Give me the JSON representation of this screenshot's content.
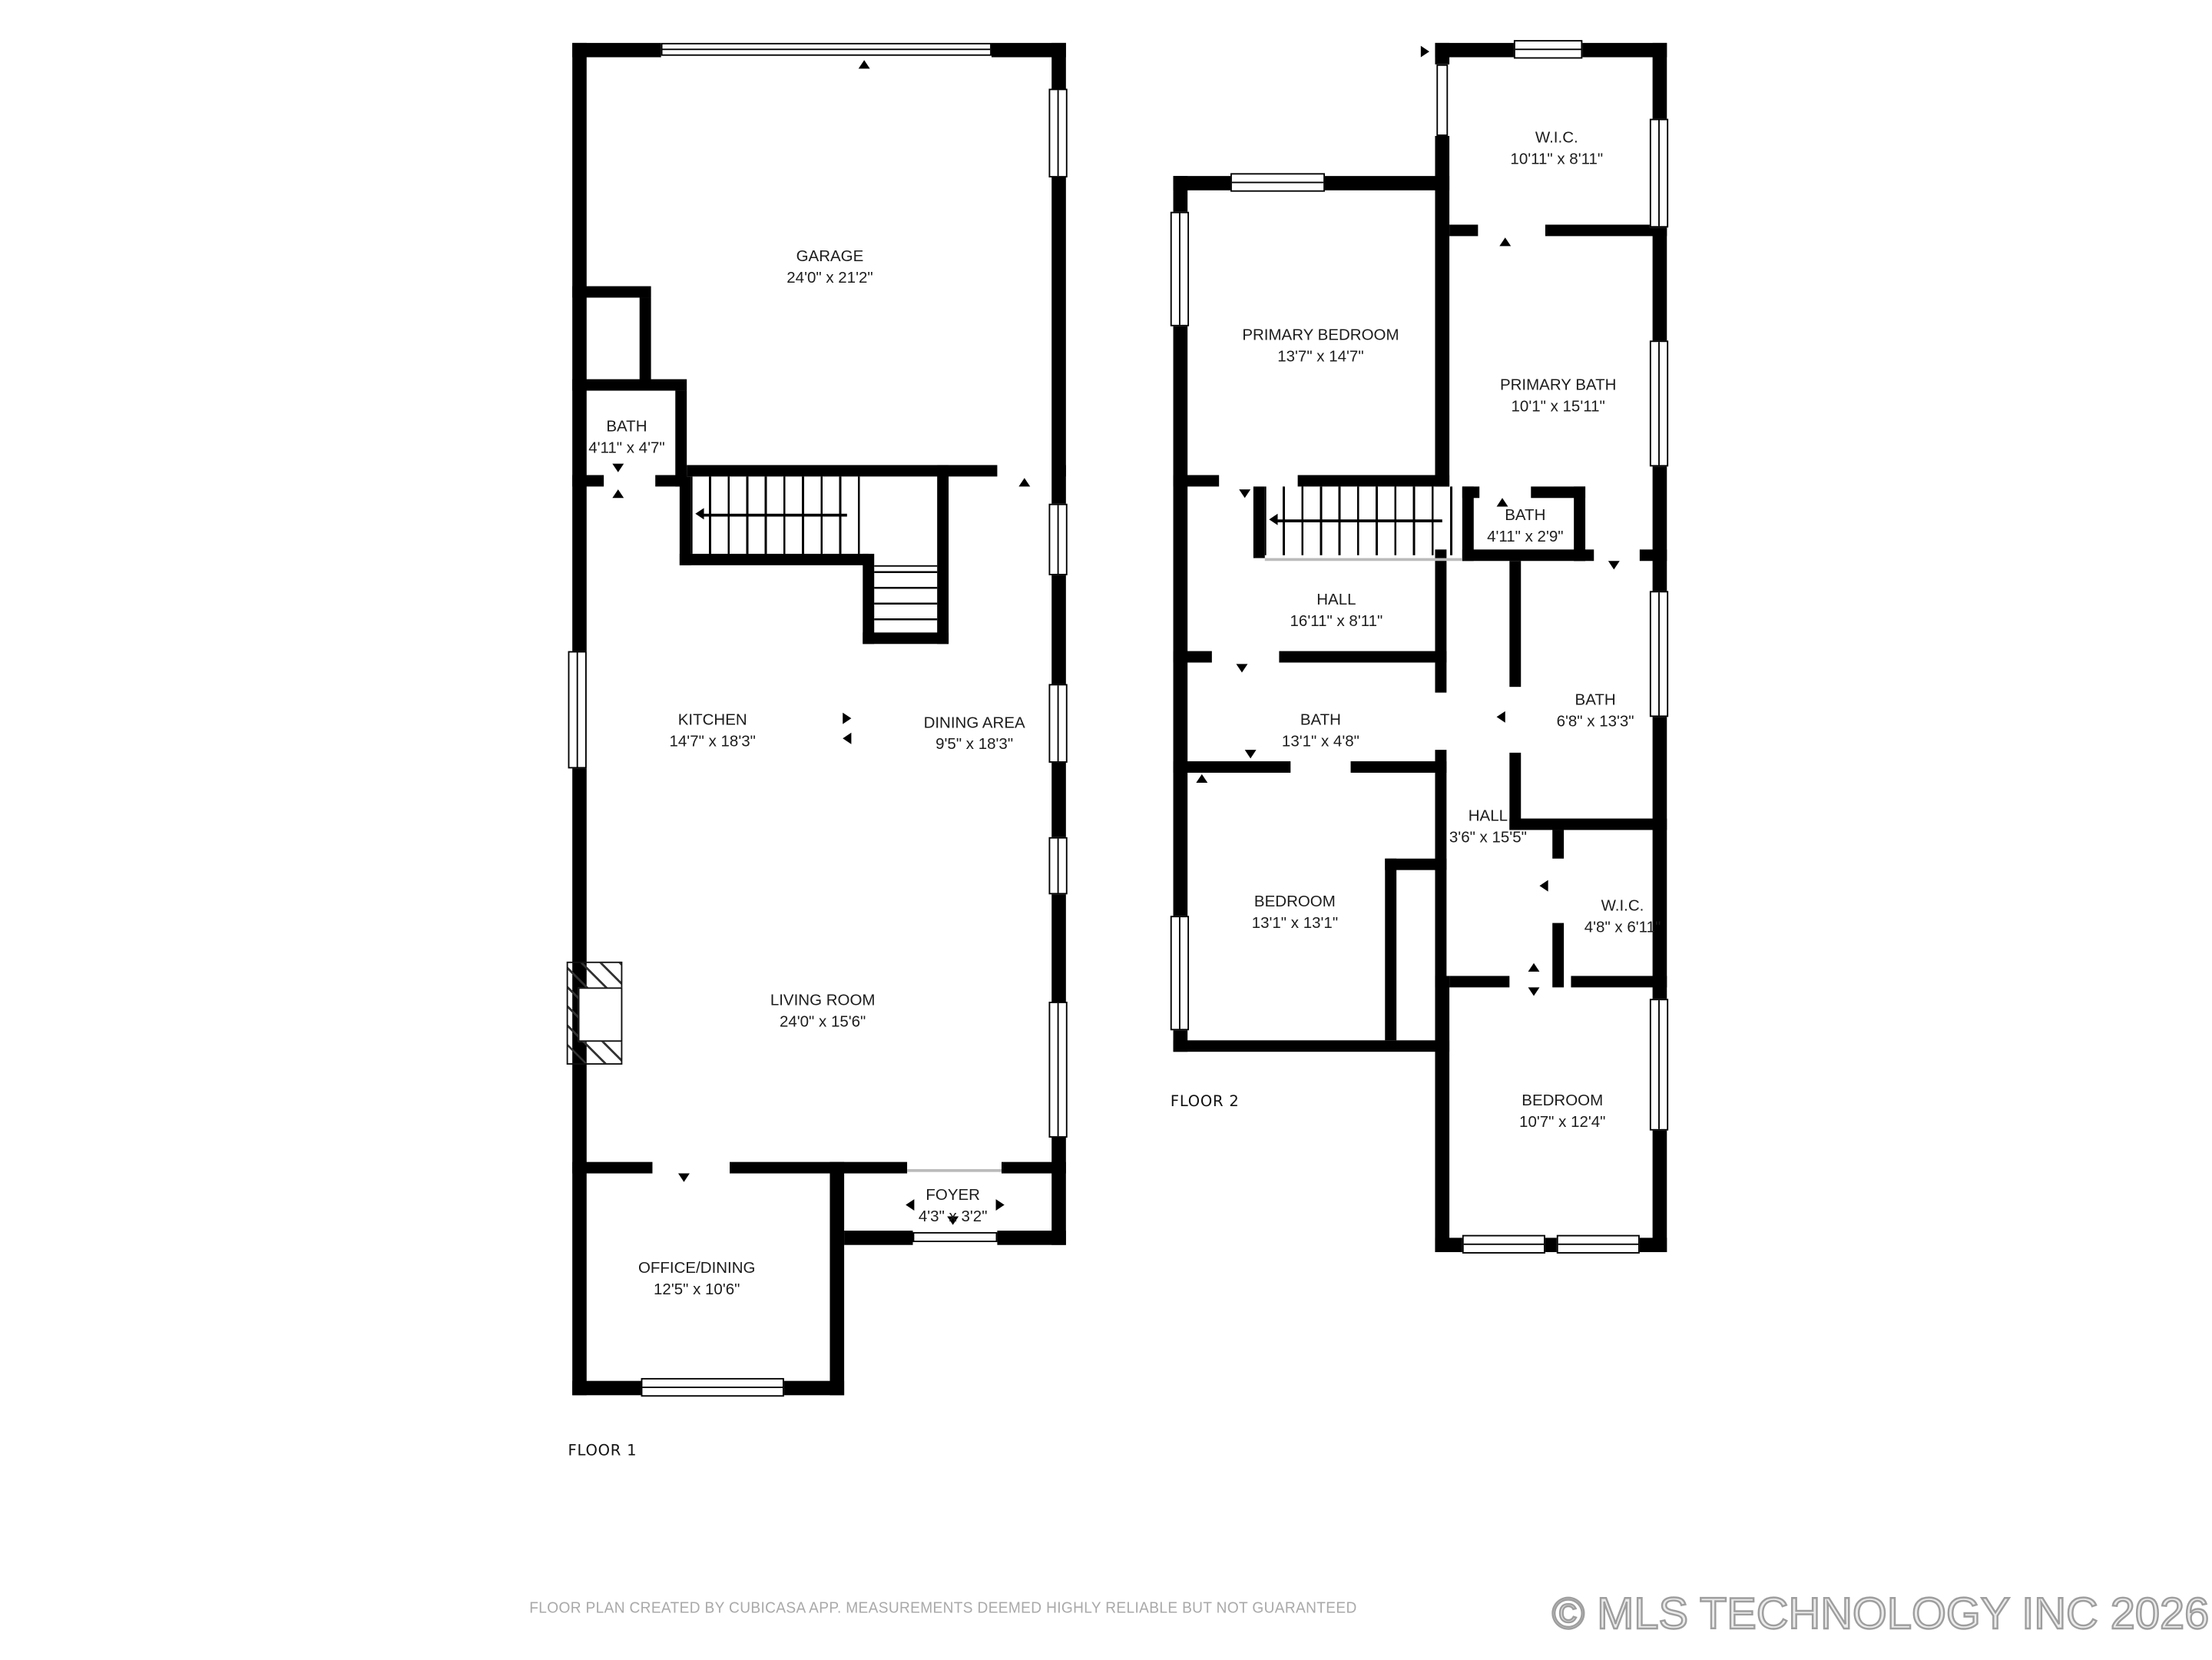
{
  "floors": [
    {
      "label": "FLOOR 1",
      "rooms": [
        {
          "name": "GARAGE",
          "dims": "24'0\" x 21'2\""
        },
        {
          "name": "BATH",
          "dims": "4'11\" x 4'7\""
        },
        {
          "name": "KITCHEN",
          "dims": "14'7\" x 18'3\""
        },
        {
          "name": "DINING AREA",
          "dims": "9'5\" x 18'3\""
        },
        {
          "name": "LIVING ROOM",
          "dims": "24'0\" x 15'6\""
        },
        {
          "name": "FOYER",
          "dims": "4'3\" x 3'2\""
        },
        {
          "name": "OFFICE/DINING",
          "dims": "12'5\" x 10'6\""
        }
      ]
    },
    {
      "label": "FLOOR 2",
      "rooms": [
        {
          "name": "W.I.C.",
          "dims": "10'11\" x 8'11\""
        },
        {
          "name": "PRIMARY BEDROOM",
          "dims": "13'7\" x 14'7\""
        },
        {
          "name": "PRIMARY BATH",
          "dims": "10'1\" x 15'11\""
        },
        {
          "name": "BATH",
          "dims": "4'11\" x 2'9\""
        },
        {
          "name": "HALL",
          "dims": "16'11\" x 8'11\""
        },
        {
          "name": "BATH",
          "dims": "13'1\" x 4'8\""
        },
        {
          "name": "BATH",
          "dims": "6'8\" x 13'3\""
        },
        {
          "name": "HALL",
          "dims": "3'6\" x 15'5\""
        },
        {
          "name": "BEDROOM",
          "dims": "13'1\" x 13'1\""
        },
        {
          "name": "W.I.C.",
          "dims": "4'8\" x 6'11\""
        },
        {
          "name": "BEDROOM",
          "dims": "10'7\" x 12'4\""
        }
      ]
    }
  ],
  "footer": {
    "disclaimer": "FLOOR PLAN CREATED BY CUBICASA APP. MEASUREMENTS DEEMED HIGHLY RELIABLE BUT NOT GUARANTEED",
    "watermark": "© MLS TECHNOLOGY INC 2026"
  },
  "colors": {
    "wall": "#000000",
    "background": "#ffffff",
    "disclaimer_text": "#a9a9a9",
    "watermark_outline": "#9e9e9e"
  }
}
